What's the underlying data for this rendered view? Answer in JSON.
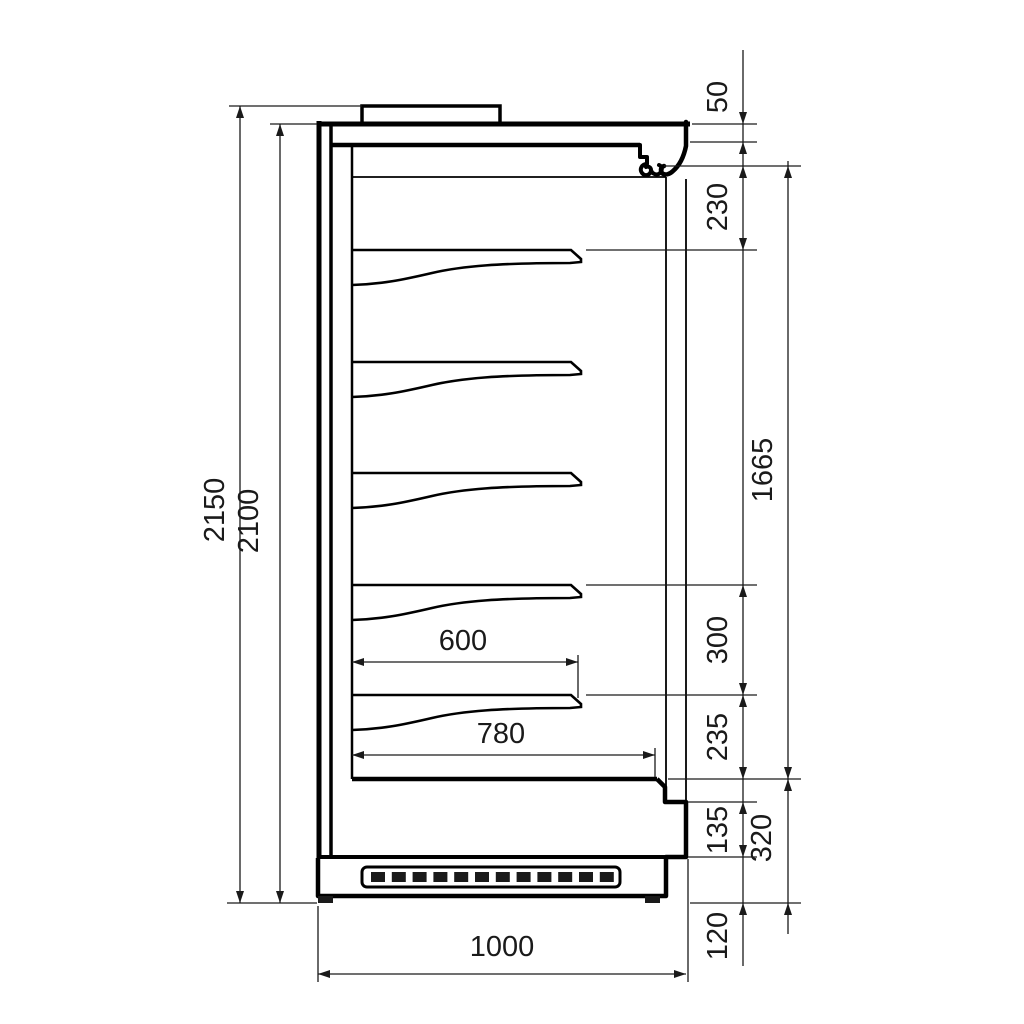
{
  "drawing": {
    "title": "Refrigerated multideck display cabinet — side section with dimensions",
    "units": "mm",
    "labels": {
      "overall_height": "2150",
      "cabinet_height": "2100",
      "top_unit_height": "50",
      "canopy_to_shelf": "230",
      "opening_height": "1665",
      "shelf_gap": "300",
      "shelf_to_deck": "235",
      "front_panel": "135",
      "deck_to_floor": "320",
      "plinth_height": "120",
      "shelf_depth": "600",
      "deck_depth": "780",
      "overall_depth": "1000"
    },
    "dimension_values_mm": {
      "vertical_left": [
        2150,
        2100
      ],
      "vertical_right_chain": [
        50,
        230,
        300,
        235,
        135,
        120
      ],
      "vertical_right_outer": [
        1665,
        320
      ],
      "horizontal": [
        600,
        780,
        1000
      ]
    },
    "features": {
      "shelf_count": 5,
      "has_bottom_deck": true,
      "has_ventilation_grille": true,
      "has_top_unit_box": true
    }
  }
}
